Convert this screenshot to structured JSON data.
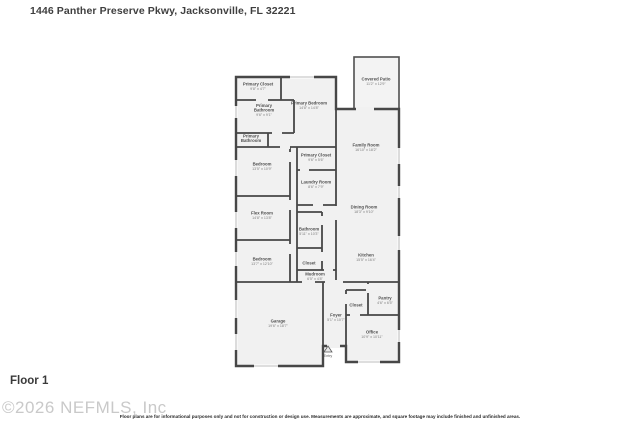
{
  "header": {
    "title": "1446 Panther Preserve Pkwy, Jacksonville, FL 32221"
  },
  "footer": {
    "floor_label": "Floor 1",
    "watermark": "©2026 NEFMLS, Inc",
    "disclaimer": "Floor plans are for informational purposes only and not for construction or design use. Measurements are approximate, and square footage may include finished and unfinished areas."
  },
  "floor_plan": {
    "colors": {
      "wall": "#474747",
      "room_fill": "#f1f1f1",
      "patio_fill": "#f3f3f3",
      "window_line": "#a8a8a8",
      "room_name": "#4f4f4f",
      "room_dims": "#7d7d7d"
    },
    "entry": {
      "label": "Entry",
      "x": 328,
      "y": 357
    },
    "rooms": [
      {
        "label_lines": [
          "Primary Closet"
        ],
        "dims": "9'8\" x 4'7\"",
        "x": 258,
        "y": 86
      },
      {
        "label_lines": [
          "Primary",
          "Bathroom"
        ],
        "dims": "9'6\" x 9'1\"",
        "x": 264,
        "y": 110
      },
      {
        "label_lines": [
          "Primary Bedroom"
        ],
        "dims": "14'8\" x 14'8\"",
        "x": 309,
        "y": 105
      },
      {
        "label_lines": [
          "Covered Patio"
        ],
        "dims": "11'2\" x 12'9\"",
        "x": 376,
        "y": 81
      },
      {
        "label_lines": [
          "Primary",
          "Bathroom"
        ],
        "dims": null,
        "x": 251,
        "y": 138
      },
      {
        "label_lines": [
          "Family Room"
        ],
        "dims": "16'10\" x 18'2\"",
        "x": 366,
        "y": 147
      },
      {
        "label_lines": [
          "Primary Closet"
        ],
        "dims": "9'6\" x 5'6\"",
        "x": 316,
        "y": 157
      },
      {
        "label_lines": [
          "Bedroom"
        ],
        "dims": "13'5\" x 10'9\"",
        "x": 262,
        "y": 166
      },
      {
        "label_lines": [
          "Laundry Room"
        ],
        "dims": "8'6\" x 7'9\"",
        "x": 316,
        "y": 184
      },
      {
        "label_lines": [
          "Dining Room"
        ],
        "dims": "18'3\" x 9'10\"",
        "x": 364,
        "y": 209
      },
      {
        "label_lines": [
          "Flex Room"
        ],
        "dims": "14'8\" x 13'8\"",
        "x": 262,
        "y": 215
      },
      {
        "label_lines": [
          "Bathroom"
        ],
        "dims": "5'11\" x 10'3\"",
        "x": 309,
        "y": 231
      },
      {
        "label_lines": [
          "Bedroom"
        ],
        "dims": "13'7\" x 12'10\"",
        "x": 262,
        "y": 261
      },
      {
        "label_lines": [
          "Closet"
        ],
        "dims": null,
        "x": 309,
        "y": 263
      },
      {
        "label_lines": [
          "Kitchen"
        ],
        "dims": "15'5\" x 16'4\"",
        "x": 366,
        "y": 257
      },
      {
        "label_lines": [
          "Mudroom"
        ],
        "dims": "6'5\" x 4'8\"",
        "x": 315,
        "y": 276
      },
      {
        "label_lines": [
          "Garage"
        ],
        "dims": "19'6\" x 18'7\"",
        "x": 278,
        "y": 323
      },
      {
        "label_lines": [
          "Foyer"
        ],
        "dims": "5'1\" x 10'7\"",
        "x": 336,
        "y": 317
      },
      {
        "label_lines": [
          "Pantry"
        ],
        "dims": "4'6\" x 6'5\"",
        "x": 385,
        "y": 300
      },
      {
        "label_lines": [
          "Closet"
        ],
        "dims": null,
        "x": 356,
        "y": 305
      },
      {
        "label_lines": [
          "Office"
        ],
        "dims": "10'9\" x 10'11\"",
        "x": 372,
        "y": 334
      }
    ]
  }
}
